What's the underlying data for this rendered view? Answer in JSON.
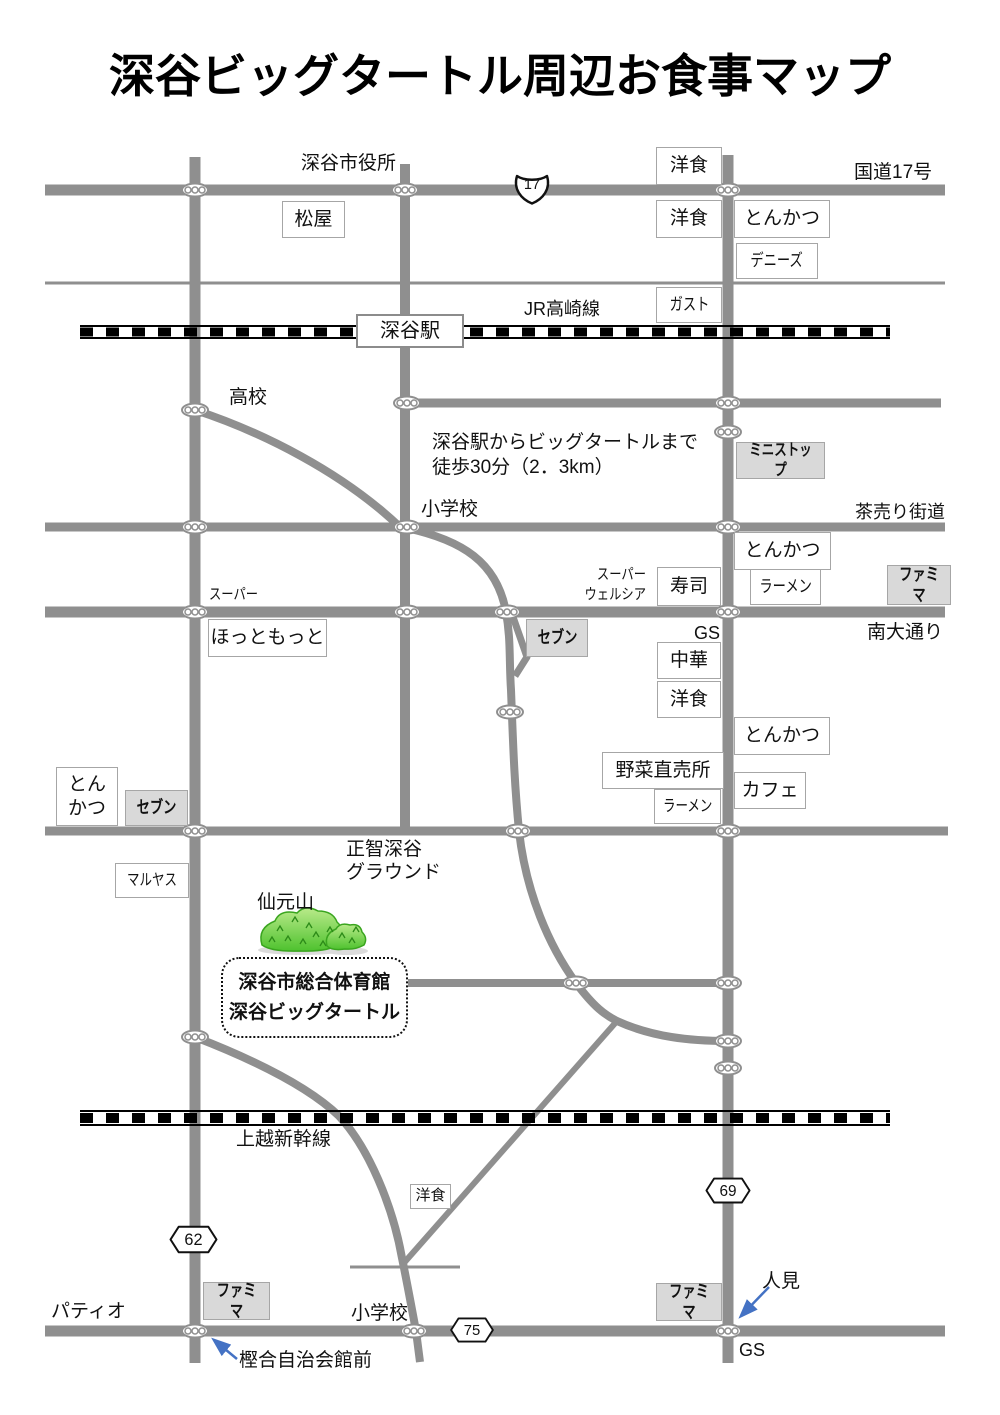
{
  "title": "深谷ビッグタートル周辺お食事マップ",
  "colors": {
    "road_gray": "#8f8f8f",
    "box_border": "#a6a6a6",
    "konbini_gray": "#d9d9d9",
    "rail_black": "#000000",
    "hill_green": "#4ec22e",
    "hill_light_green": "#b9ea8a",
    "arrow_blue": "#4472c4"
  },
  "route_badges": [
    {
      "name": "route-17-badge",
      "shape": "national-shield",
      "number": "17",
      "x": 511,
      "y": 170,
      "w": 42,
      "h": 37
    },
    {
      "name": "route-62-badge",
      "shape": "hexagon",
      "number": "62",
      "x": 169,
      "y": 1225,
      "w": 49,
      "h": 29
    },
    {
      "name": "route-69-badge",
      "shape": "hexagon",
      "number": "69",
      "x": 705,
      "y": 1177,
      "w": 46,
      "h": 27
    },
    {
      "name": "route-75-badge",
      "shape": "hexagon",
      "number": "75",
      "x": 449,
      "y": 1317,
      "w": 46,
      "h": 26
    }
  ],
  "boxes": [
    {
      "name": "yoshoku-route17-north-box",
      "lines": [
        "洋食"
      ],
      "x": 656,
      "y": 147,
      "w": 66,
      "h": 38,
      "style": "white"
    },
    {
      "name": "yoshoku-route17-south-box",
      "lines": [
        "洋食"
      ],
      "x": 656,
      "y": 200,
      "w": 66,
      "h": 38,
      "style": "white"
    },
    {
      "name": "tonkatsu-route17-box",
      "lines": [
        "とんかつ"
      ],
      "x": 734,
      "y": 200,
      "w": 96,
      "h": 38,
      "style": "white"
    },
    {
      "name": "dennys-box",
      "lines": [
        "デニーズ"
      ],
      "x": 736,
      "y": 243,
      "w": 82,
      "h": 36,
      "style": "white",
      "narrow": true,
      "fs": 17
    },
    {
      "name": "gusto-box",
      "lines": [
        "ガスト"
      ],
      "x": 656,
      "y": 287,
      "w": 66,
      "h": 36,
      "style": "white",
      "narrow": true,
      "fs": 17
    },
    {
      "name": "matsuya-box",
      "lines": [
        "松屋"
      ],
      "x": 282,
      "y": 201,
      "w": 63,
      "h": 37,
      "style": "white"
    },
    {
      "name": "fukaya-station-box",
      "lines": [
        "深谷駅"
      ],
      "x": 356,
      "y": 314,
      "w": 108,
      "h": 34,
      "style": "station"
    },
    {
      "name": "ministop-box",
      "lines": [
        "ミニストップ"
      ],
      "x": 736,
      "y": 442,
      "w": 89,
      "h": 37,
      "style": "gray",
      "narrow": true,
      "bold": true,
      "fs": 16
    },
    {
      "name": "tonkatsu-chaurikaido-box",
      "lines": [
        "とんかつ"
      ],
      "x": 734,
      "y": 532,
      "w": 97,
      "h": 38,
      "style": "white"
    },
    {
      "name": "sushi-box",
      "lines": [
        "寿司"
      ],
      "x": 657,
      "y": 567,
      "w": 64,
      "h": 39,
      "style": "white"
    },
    {
      "name": "ramen-chaurikaido-box",
      "lines": [
        "ラーメン"
      ],
      "x": 750,
      "y": 569,
      "w": 71,
      "h": 36,
      "style": "white",
      "narrow": true,
      "fs": 17
    },
    {
      "name": "famima-chaurikaido-box",
      "lines": [
        "ファミマ"
      ],
      "x": 887,
      "y": 565,
      "w": 64,
      "h": 40,
      "style": "gray",
      "narrow": true,
      "bold": true,
      "fs": 17
    },
    {
      "name": "hottomotto-box",
      "lines": [
        "ほっともっと"
      ],
      "x": 208,
      "y": 619,
      "w": 119,
      "h": 38,
      "style": "white"
    },
    {
      "name": "seven-minamiodori-box",
      "lines": [
        "セブン"
      ],
      "x": 526,
      "y": 619,
      "w": 62,
      "h": 38,
      "style": "gray",
      "narrow": true,
      "bold": true,
      "fs": 17
    },
    {
      "name": "chuka-box",
      "lines": [
        "中華"
      ],
      "x": 657,
      "y": 642,
      "w": 64,
      "h": 37,
      "style": "white"
    },
    {
      "name": "yoshoku-minamiodori-box",
      "lines": [
        "洋食"
      ],
      "x": 657,
      "y": 681,
      "w": 64,
      "h": 37,
      "style": "white"
    },
    {
      "name": "tonkatsu-east-box",
      "lines": [
        "とんかつ"
      ],
      "x": 734,
      "y": 717,
      "w": 96,
      "h": 38,
      "style": "white"
    },
    {
      "name": "yasai-chokubaijo-box",
      "lines": [
        "野菜直売所"
      ],
      "x": 602,
      "y": 752,
      "w": 122,
      "h": 37,
      "style": "white"
    },
    {
      "name": "cafe-box",
      "lines": [
        "カフェ"
      ],
      "x": 734,
      "y": 772,
      "w": 72,
      "h": 37,
      "style": "white"
    },
    {
      "name": "ramen-south-box",
      "lines": [
        "ラーメン"
      ],
      "x": 654,
      "y": 789,
      "w": 67,
      "h": 35,
      "style": "white",
      "narrow": true,
      "fs": 16
    },
    {
      "name": "tonkatsu-west-box",
      "lines": [
        "とん",
        "かつ"
      ],
      "x": 56,
      "y": 767,
      "w": 62,
      "h": 59,
      "style": "white"
    },
    {
      "name": "seven-west-box",
      "lines": [
        "セブン"
      ],
      "x": 125,
      "y": 790,
      "w": 63,
      "h": 36,
      "style": "gray",
      "narrow": true,
      "bold": true,
      "fs": 17
    },
    {
      "name": "maruyasu-box",
      "lines": [
        "マルヤス"
      ],
      "x": 115,
      "y": 863,
      "w": 74,
      "h": 35,
      "style": "white",
      "narrow": true,
      "fs": 16
    },
    {
      "name": "big-turtle-box",
      "lines": [
        "深谷市総合体育館",
        "深谷ビッグタートル"
      ],
      "x": 221,
      "y": 957,
      "w": 187,
      "h": 81,
      "style": "dotted",
      "bold": true
    },
    {
      "name": "yoshoku-shinkansen-box",
      "lines": [
        "洋食"
      ],
      "x": 410,
      "y": 1184,
      "w": 41,
      "h": 25,
      "style": "white",
      "fs": 15
    },
    {
      "name": "famima-patio-box",
      "lines": [
        "ファミマ"
      ],
      "x": 203,
      "y": 1282,
      "w": 67,
      "h": 38,
      "style": "gray",
      "narrow": true,
      "bold": true,
      "fs": 17
    },
    {
      "name": "famima-hitomi-box",
      "lines": [
        "ファミマ"
      ],
      "x": 656,
      "y": 1283,
      "w": 66,
      "h": 38,
      "style": "gray",
      "narrow": true,
      "bold": true,
      "fs": 17
    }
  ],
  "labels": [
    {
      "name": "city-hall-label",
      "lines": [
        "深谷市役所"
      ],
      "x": 301,
      "y": 153,
      "fs": 19
    },
    {
      "name": "route17-name-label",
      "lines": [
        "国道17号"
      ],
      "x": 854,
      "y": 162,
      "fs": 19
    },
    {
      "name": "jr-takasaki-label",
      "lines": [
        "JR高崎線"
      ],
      "x": 524,
      "y": 299,
      "fs": 18
    },
    {
      "name": "highschool-label",
      "lines": [
        "高校"
      ],
      "x": 229,
      "y": 387,
      "fs": 19
    },
    {
      "name": "walk-note",
      "lines": [
        "深谷駅からビッグタートルまで",
        "徒歩30分（2．3km）"
      ],
      "x": 432,
      "y": 430,
      "fs": 19,
      "lh": 1.32
    },
    {
      "name": "shogakko-north-label",
      "lines": [
        "小学校"
      ],
      "x": 421,
      "y": 499,
      "fs": 19
    },
    {
      "name": "chaurikaido-label",
      "lines": [
        "茶売り街道"
      ],
      "x": 855,
      "y": 502,
      "fs": 18
    },
    {
      "name": "super-west-label",
      "lines": [
        "スーパー"
      ],
      "x": 209,
      "y": 586,
      "fs": 15,
      "narrow": true
    },
    {
      "name": "super-welcia-label",
      "lines": [
        "スーパー",
        "ウェルシア"
      ],
      "x": 560,
      "y": 565,
      "fs": 15,
      "narrow": true,
      "align": "right",
      "w": 86,
      "lh": 1.3
    },
    {
      "name": "gs-minamiodori-label",
      "lines": [
        "GS"
      ],
      "x": 694,
      "y": 623,
      "fs": 18
    },
    {
      "name": "minamiodori-label",
      "lines": [
        "南大通り"
      ],
      "x": 867,
      "y": 622,
      "fs": 19
    },
    {
      "name": "seichi-ground-label",
      "lines": [
        "正智深谷",
        "グラウンド"
      ],
      "x": 346,
      "y": 839,
      "fs": 19,
      "lh": 1.2
    },
    {
      "name": "sengenyama-label",
      "lines": [
        "仙元山"
      ],
      "x": 257,
      "y": 892,
      "fs": 19
    },
    {
      "name": "joetsu-shinkansen-label",
      "lines": [
        "上越新幹線"
      ],
      "x": 236,
      "y": 1129,
      "fs": 19
    },
    {
      "name": "patio-label",
      "lines": [
        "パティオ"
      ],
      "x": 51,
      "y": 1301,
      "fs": 19
    },
    {
      "name": "shogakko-south-label",
      "lines": [
        "小学校"
      ],
      "x": 351,
      "y": 1303,
      "fs": 19
    },
    {
      "name": "kashiai-jichikaikan-label",
      "lines": [
        "樫合自治会館前"
      ],
      "x": 239,
      "y": 1350,
      "fs": 19
    },
    {
      "name": "hitomi-label",
      "lines": [
        "人見"
      ],
      "x": 762,
      "y": 1271,
      "fs": 19
    },
    {
      "name": "gs-hitomi-label",
      "lines": [
        "GS"
      ],
      "x": 739,
      "y": 1340,
      "fs": 18
    }
  ]
}
